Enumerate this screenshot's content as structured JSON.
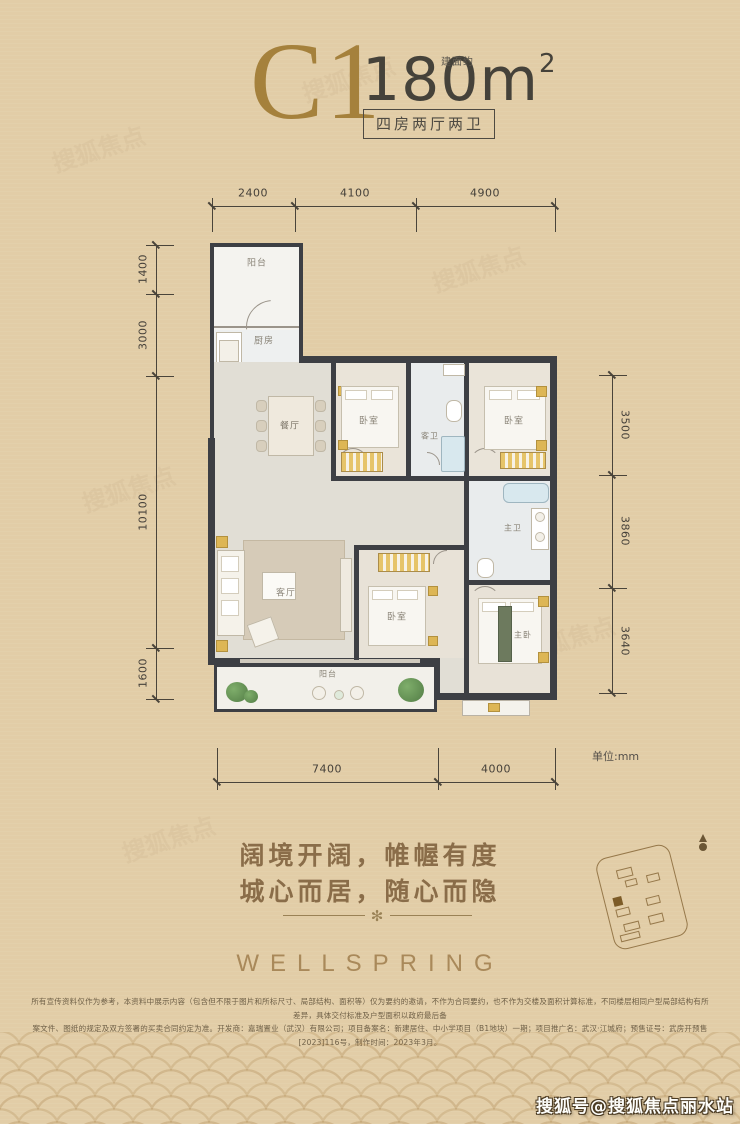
{
  "header": {
    "unit_type": "C1",
    "area_prefix": "建面约",
    "area_value": "180m",
    "area_sup": "2",
    "layout_badge": "四房两厅两卫"
  },
  "floor_plan": {
    "unit_note": "单位:mm",
    "dimensions": {
      "top": [
        "2400",
        "4100",
        "4900"
      ],
      "left": [
        "1400",
        "3000",
        "10100",
        "1600"
      ],
      "right": [
        "3500",
        "3860",
        "3640"
      ],
      "bottom": [
        "7400",
        "4000"
      ]
    },
    "rooms": [
      {
        "id": "balcony-top",
        "label": "阳台"
      },
      {
        "id": "kitchen",
        "label": "厨房"
      },
      {
        "id": "dining",
        "label": "餐厅"
      },
      {
        "id": "bedroom-2",
        "label": "卧室"
      },
      {
        "id": "guest-bath",
        "label": "客卫"
      },
      {
        "id": "bedroom-3",
        "label": "卧室"
      },
      {
        "id": "master-bath",
        "label": "主卫"
      },
      {
        "id": "living",
        "label": "客厅"
      },
      {
        "id": "bedroom-4",
        "label": "卧室"
      },
      {
        "id": "master-bedroom",
        "label": "主卧"
      },
      {
        "id": "balcony-bottom",
        "label": "阳台"
      }
    ]
  },
  "tagline": {
    "line1": "阔境开阔，帷幄有度",
    "line2": "城心而居，随心而隐",
    "ornament": "✻"
  },
  "brand": {
    "name": "WELLSPRING"
  },
  "disclaimer": {
    "line1": "所有宣传资料仅作为参考，本资料中展示内容（包含但不限于图片和所标尺寸、局部结构、面积等）仅为要约的邀请，不作为合同要约，也不作为交楼及面积计算标准，不同楼层相同户型局部结构有所差异，具体交付标准及户型面积以政府最后备",
    "line2": "案文件、图纸的规定及双方签署的买卖合同约定为准。开发商：嘉瑞置业（武汉）有限公司；项目备案名：新建居住、中小学项目（B1地块）一期；项目推广名：武汉·江城府；预售证号：武房开预售[2023]116号，制作时间：2023年3月。"
  },
  "watermark": {
    "badge": "搜狐号@搜狐焦点丽水站",
    "tile": "搜狐焦点"
  }
}
